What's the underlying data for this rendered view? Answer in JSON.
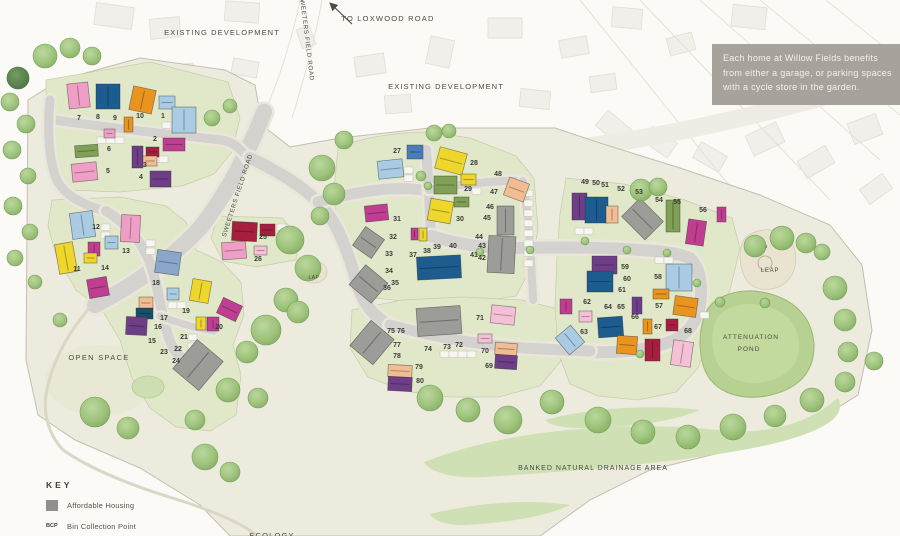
{
  "info_box": {
    "bg": "#a7a29b",
    "lines": [
      "Each home at Willow Fields benefits",
      "from either a garage, or parking spaces",
      "with a cycle store in the garden."
    ]
  },
  "key": {
    "title": "KEY",
    "items": [
      {
        "type": "swatch",
        "swatch_color": "#8f8f8b",
        "abbr": "",
        "label": "Affordable Housing"
      },
      {
        "type": "abbr",
        "abbr": "BCP",
        "label": "Bin Collection Point"
      },
      {
        "type": "abbr",
        "abbr": "LEAP",
        "label": "(Local Equipped Area of Play)"
      }
    ]
  },
  "labels": [
    {
      "id": "existing-development-1",
      "text": "EXISTING DEVELOPMENT",
      "x": 222,
      "y": 35,
      "size": 7.5,
      "ls": 1.1,
      "rot": 0
    },
    {
      "id": "existing-development-2",
      "text": "EXISTING DEVELOPMENT",
      "x": 446,
      "y": 89,
      "size": 7.5,
      "ls": 1.1,
      "rot": 0
    },
    {
      "id": "to-loxwood-road",
      "text": "TO LOXWOOD ROAD",
      "x": 388,
      "y": 21,
      "size": 7.5,
      "ls": 1.2,
      "rot": 0
    },
    {
      "id": "sweeters-field-road-top",
      "text": "SWEETERS FIELD ROAD",
      "x": 305,
      "y": 38,
      "size": 6.2,
      "ls": 0.7,
      "rot": 83
    },
    {
      "id": "sweeters-field-road-lower",
      "text": "SWEETERS FIELD ROAD",
      "x": 239,
      "y": 196,
      "size": 6.2,
      "ls": 0.7,
      "rot": -72
    },
    {
      "id": "open-space",
      "text": "OPEN SPACE",
      "x": 99,
      "y": 360,
      "size": 7.5,
      "ls": 1.3,
      "rot": 0
    },
    {
      "id": "lap",
      "text": "LAP",
      "x": 314,
      "y": 279,
      "size": 5,
      "ls": 0.5,
      "rot": 0
    },
    {
      "id": "leap",
      "text": "LEAP",
      "x": 770,
      "y": 272,
      "size": 6,
      "ls": 0.8,
      "rot": 0
    },
    {
      "id": "attenuation-pond-1",
      "text": "ATTENUATION",
      "x": 751,
      "y": 339,
      "size": 6.5,
      "ls": 1,
      "rot": 0
    },
    {
      "id": "attenuation-pond-2",
      "text": "POND",
      "x": 749,
      "y": 351,
      "size": 6.5,
      "ls": 1,
      "rot": 0
    },
    {
      "id": "banked-natural-drainage-area",
      "text": "BANKED NATURAL DRAINAGE AREA",
      "x": 593,
      "y": 470,
      "size": 7,
      "ls": 1,
      "rot": 0
    },
    {
      "id": "ecology",
      "text": "ECOLOGY",
      "x": 272,
      "y": 538,
      "size": 7.5,
      "ls": 1.2,
      "rot": 0
    }
  ],
  "palette": {
    "pink": "#ef9fc6",
    "pinkl": "#f4c0d6",
    "navy": "#1d5c8e",
    "orange": "#e8941f",
    "ltblue": "#a9cbe4",
    "green": "#7fa055",
    "yellow": "#eed62c",
    "magenta": "#bf3e92",
    "red": "#a61f3e",
    "purple": "#6f3e88",
    "peach": "#f2bd92",
    "bluegray": "#8aa6cb",
    "teal": "#174f6b",
    "gray": "#9c9c98",
    "gray2": "#8f8f8b",
    "blue": "#4a7cb8"
  },
  "plots": [
    [
      1,
      163,
      118
    ],
    [
      2,
      155,
      141
    ],
    [
      3,
      145,
      167
    ],
    [
      4,
      141,
      179
    ],
    [
      5,
      108,
      173
    ],
    [
      6,
      109,
      151
    ],
    [
      7,
      79,
      120
    ],
    [
      8,
      98,
      119
    ],
    [
      9,
      115,
      120
    ],
    [
      10,
      140,
      118
    ],
    [
      11,
      77,
      271
    ],
    [
      12,
      96,
      229
    ],
    [
      13,
      126,
      253
    ],
    [
      14,
      105,
      270
    ],
    [
      15,
      152,
      343
    ],
    [
      16,
      158,
      329
    ],
    [
      17,
      164,
      320
    ],
    [
      18,
      156,
      285
    ],
    [
      19,
      186,
      313
    ],
    [
      20,
      219,
      329
    ],
    [
      21,
      184,
      339
    ],
    [
      22,
      178,
      351
    ],
    [
      23,
      164,
      354
    ],
    [
      24,
      176,
      363
    ],
    [
      25,
      263,
      239
    ],
    [
      26,
      258,
      261
    ],
    [
      27,
      397,
      153
    ],
    [
      28,
      474,
      165
    ],
    [
      29,
      468,
      191
    ],
    [
      30,
      460,
      221
    ],
    [
      31,
      397,
      221
    ],
    [
      32,
      393,
      239
    ],
    [
      33,
      389,
      256
    ],
    [
      34,
      389,
      273
    ],
    [
      35,
      395,
      285
    ],
    [
      36,
      387,
      290
    ],
    [
      37,
      413,
      257
    ],
    [
      38,
      427,
      253
    ],
    [
      39,
      437,
      249
    ],
    [
      40,
      453,
      248
    ],
    [
      41,
      474,
      257
    ],
    [
      42,
      482,
      260
    ],
    [
      43,
      482,
      248
    ],
    [
      44,
      479,
      239
    ],
    [
      45,
      487,
      220
    ],
    [
      46,
      490,
      209
    ],
    [
      47,
      494,
      194
    ],
    [
      48,
      498,
      176
    ],
    [
      49,
      585,
      184
    ],
    [
      50,
      596,
      185
    ],
    [
      51,
      605,
      187
    ],
    [
      52,
      621,
      191
    ],
    [
      53,
      639,
      194
    ],
    [
      54,
      659,
      202
    ],
    [
      55,
      677,
      204
    ],
    [
      56,
      703,
      212
    ],
    [
      57,
      659,
      308
    ],
    [
      58,
      658,
      279
    ],
    [
      59,
      625,
      269
    ],
    [
      60,
      627,
      281
    ],
    [
      61,
      622,
      292
    ],
    [
      62,
      587,
      304
    ],
    [
      63,
      584,
      334
    ],
    [
      64,
      608,
      309
    ],
    [
      65,
      621,
      309
    ],
    [
      66,
      635,
      319
    ],
    [
      67,
      658,
      329
    ],
    [
      68,
      688,
      333
    ],
    [
      69,
      489,
      368
    ],
    [
      70,
      485,
      353
    ],
    [
      71,
      480,
      320
    ],
    [
      72,
      459,
      347
    ],
    [
      73,
      447,
      349
    ],
    [
      74,
      428,
      351
    ],
    [
      75,
      391,
      333
    ],
    [
      76,
      401,
      333
    ],
    [
      77,
      397,
      347
    ],
    [
      78,
      397,
      358
    ],
    [
      79,
      419,
      369
    ],
    [
      80,
      420,
      383
    ]
  ],
  "houses": [
    [
      68,
      83,
      21,
      25,
      -6,
      "pink"
    ],
    [
      96,
      84,
      24,
      25,
      0,
      "navy"
    ],
    [
      131,
      88,
      23,
      24,
      12,
      "orange"
    ],
    [
      159,
      96,
      16,
      13,
      0,
      "ltblue"
    ],
    [
      172,
      107,
      24,
      26,
      0,
      "ltblue"
    ],
    [
      124,
      117,
      9,
      15,
      0,
      "orange"
    ],
    [
      104,
      129,
      11,
      9,
      0,
      "pink"
    ],
    [
      163,
      138,
      22,
      13,
      0,
      "magenta"
    ],
    [
      146,
      147,
      13,
      10,
      0,
      "red"
    ],
    [
      132,
      146,
      11,
      22,
      0,
      "purple"
    ],
    [
      75,
      145,
      23,
      12,
      -4,
      "green"
    ],
    [
      143,
      156,
      14,
      10,
      0,
      "peach"
    ],
    [
      72,
      163,
      25,
      18,
      -6,
      "pink"
    ],
    [
      150,
      171,
      21,
      16,
      0,
      "purple"
    ],
    [
      71,
      212,
      23,
      26,
      -8,
      "ltblue"
    ],
    [
      121,
      215,
      19,
      27,
      3,
      "pink"
    ],
    [
      105,
      236,
      13,
      13,
      0,
      "ltblue"
    ],
    [
      57,
      243,
      18,
      30,
      -10,
      "yellow"
    ],
    [
      88,
      242,
      12,
      14,
      0,
      "magenta"
    ],
    [
      84,
      253,
      13,
      10,
      0,
      "yellow"
    ],
    [
      88,
      278,
      20,
      19,
      -10,
      "magenta"
    ],
    [
      156,
      251,
      24,
      23,
      8,
      "bluegray"
    ],
    [
      167,
      288,
      12,
      12,
      0,
      "ltblue"
    ],
    [
      191,
      280,
      19,
      22,
      10,
      "yellow"
    ],
    [
      139,
      297,
      14,
      12,
      0,
      "peach"
    ],
    [
      136,
      308,
      17,
      11,
      0,
      "teal"
    ],
    [
      126,
      317,
      21,
      18,
      3,
      "purple"
    ],
    [
      196,
      317,
      10,
      13,
      0,
      "yellow"
    ],
    [
      207,
      317,
      12,
      14,
      0,
      "magenta"
    ],
    [
      219,
      301,
      21,
      17,
      25,
      "magenta"
    ],
    [
      181,
      346,
      34,
      38,
      40,
      "gray"
    ],
    [
      232,
      222,
      25,
      19,
      3,
      "red"
    ],
    [
      260,
      224,
      15,
      12,
      0,
      "red"
    ],
    [
      222,
      242,
      24,
      17,
      -4,
      "pink"
    ],
    [
      254,
      246,
      13,
      9,
      0,
      "pinkl"
    ],
    [
      407,
      145,
      16,
      14,
      0,
      "blue"
    ],
    [
      378,
      160,
      25,
      18,
      -6,
      "ltblue"
    ],
    [
      437,
      150,
      28,
      22,
      15,
      "yellow"
    ],
    [
      461,
      174,
      15,
      11,
      0,
      "yellow"
    ],
    [
      434,
      176,
      23,
      18,
      0,
      "green"
    ],
    [
      454,
      197,
      15,
      10,
      0,
      "green"
    ],
    [
      429,
      200,
      23,
      22,
      10,
      "yellow"
    ],
    [
      365,
      205,
      23,
      16,
      -6,
      "magenta"
    ],
    [
      357,
      231,
      23,
      23,
      35,
      "gray"
    ],
    [
      411,
      228,
      7,
      12,
      0,
      "magenta"
    ],
    [
      419,
      228,
      8,
      13,
      0,
      "yellow"
    ],
    [
      506,
      180,
      21,
      19,
      20,
      "peach"
    ],
    [
      497,
      206,
      17,
      29,
      0,
      "gray"
    ],
    [
      488,
      236,
      27,
      37,
      3,
      "gray"
    ],
    [
      354,
      271,
      29,
      26,
      40,
      "gray"
    ],
    [
      417,
      256,
      44,
      23,
      -3,
      "navy"
    ],
    [
      357,
      326,
      30,
      33,
      40,
      "gray"
    ],
    [
      417,
      307,
      44,
      28,
      -4,
      "gray"
    ],
    [
      388,
      365,
      24,
      12,
      3,
      "peach"
    ],
    [
      388,
      377,
      24,
      14,
      3,
      "purple"
    ],
    [
      491,
      306,
      24,
      18,
      6,
      "pinkl"
    ],
    [
      478,
      334,
      14,
      9,
      0,
      "pinkl"
    ],
    [
      495,
      343,
      22,
      12,
      4,
      "peach"
    ],
    [
      495,
      355,
      22,
      14,
      4,
      "purple"
    ],
    [
      572,
      193,
      15,
      27,
      0,
      "purple"
    ],
    [
      585,
      197,
      23,
      26,
      0,
      "navy"
    ],
    [
      606,
      206,
      12,
      17,
      0,
      "peach"
    ],
    [
      626,
      206,
      33,
      26,
      45,
      "gray"
    ],
    [
      666,
      200,
      14,
      32,
      0,
      "green"
    ],
    [
      687,
      220,
      18,
      25,
      8,
      "magenta"
    ],
    [
      717,
      207,
      9,
      15,
      0,
      "magenta"
    ],
    [
      592,
      256,
      25,
      18,
      0,
      "purple"
    ],
    [
      587,
      271,
      26,
      21,
      0,
      "navy"
    ],
    [
      666,
      264,
      26,
      27,
      0,
      "ltblue"
    ],
    [
      653,
      289,
      16,
      10,
      0,
      "orange"
    ],
    [
      632,
      297,
      10,
      17,
      0,
      "purple"
    ],
    [
      674,
      297,
      23,
      19,
      8,
      "orange"
    ],
    [
      560,
      299,
      12,
      15,
      0,
      "magenta"
    ],
    [
      579,
      311,
      13,
      11,
      0,
      "pinkl"
    ],
    [
      598,
      317,
      25,
      20,
      -4,
      "navy"
    ],
    [
      560,
      329,
      20,
      22,
      -40,
      "ltblue"
    ],
    [
      617,
      336,
      20,
      18,
      4,
      "orange"
    ],
    [
      643,
      319,
      9,
      15,
      0,
      "orange"
    ],
    [
      645,
      339,
      15,
      22,
      0,
      "red"
    ],
    [
      666,
      319,
      12,
      12,
      0,
      "red"
    ],
    [
      672,
      341,
      20,
      25,
      8,
      "pinkl"
    ]
  ],
  "trees": [
    [
      45,
      56,
      12,
      0
    ],
    [
      70,
      48,
      10,
      0
    ],
    [
      92,
      56,
      9,
      0
    ],
    [
      18,
      78,
      11,
      1
    ],
    [
      10,
      102,
      9,
      0
    ],
    [
      26,
      124,
      9,
      0
    ],
    [
      12,
      150,
      9,
      0
    ],
    [
      28,
      176,
      8,
      0
    ],
    [
      13,
      206,
      9,
      0
    ],
    [
      30,
      232,
      8,
      0
    ],
    [
      15,
      258,
      8,
      0
    ],
    [
      35,
      282,
      7,
      0
    ],
    [
      60,
      320,
      7,
      0
    ],
    [
      95,
      412,
      15,
      0
    ],
    [
      128,
      428,
      11,
      0
    ],
    [
      205,
      457,
      13,
      0
    ],
    [
      230,
      472,
      10,
      0
    ],
    [
      212,
      118,
      8,
      0
    ],
    [
      230,
      106,
      7,
      0
    ],
    [
      322,
      168,
      13,
      0
    ],
    [
      334,
      194,
      11,
      0
    ],
    [
      320,
      216,
      9,
      0
    ],
    [
      290,
      240,
      14,
      0
    ],
    [
      308,
      268,
      13,
      0
    ],
    [
      286,
      300,
      12,
      0
    ],
    [
      266,
      330,
      15,
      0
    ],
    [
      298,
      312,
      11,
      0
    ],
    [
      247,
      352,
      11,
      0
    ],
    [
      228,
      390,
      12,
      0
    ],
    [
      258,
      398,
      10,
      0
    ],
    [
      195,
      420,
      10,
      0
    ],
    [
      344,
      140,
      9,
      0
    ],
    [
      434,
      133,
      8,
      0
    ],
    [
      449,
      131,
      7,
      0
    ],
    [
      421,
      176,
      5,
      0
    ],
    [
      428,
      186,
      4,
      0
    ],
    [
      641,
      190,
      11,
      0
    ],
    [
      658,
      187,
      9,
      0
    ],
    [
      585,
      241,
      4,
      0
    ],
    [
      627,
      250,
      4,
      0
    ],
    [
      667,
      253,
      4,
      0
    ],
    [
      697,
      283,
      4,
      0
    ],
    [
      640,
      354,
      4,
      0
    ],
    [
      530,
      250,
      4,
      0
    ],
    [
      480,
      252,
      4,
      0
    ],
    [
      755,
      246,
      11,
      0
    ],
    [
      782,
      238,
      12,
      0
    ],
    [
      806,
      243,
      10,
      0
    ],
    [
      822,
      252,
      8,
      0
    ],
    [
      835,
      288,
      12,
      0
    ],
    [
      845,
      320,
      11,
      0
    ],
    [
      848,
      352,
      10,
      0
    ],
    [
      720,
      302,
      5,
      0
    ],
    [
      765,
      303,
      5,
      0
    ],
    [
      430,
      398,
      13,
      0
    ],
    [
      468,
      410,
      12,
      0
    ],
    [
      508,
      420,
      14,
      0
    ],
    [
      552,
      402,
      12,
      0
    ],
    [
      598,
      420,
      13,
      0
    ],
    [
      643,
      432,
      12,
      0
    ],
    [
      688,
      437,
      12,
      0
    ],
    [
      733,
      427,
      13,
      0
    ],
    [
      775,
      416,
      11,
      0
    ],
    [
      812,
      400,
      12,
      0
    ],
    [
      845,
      382,
      10,
      0
    ],
    [
      874,
      361,
      9,
      0
    ]
  ],
  "parking": [
    [
      162,
      122
    ],
    [
      171,
      122
    ],
    [
      150,
      156
    ],
    [
      159,
      156
    ],
    [
      97,
      137
    ],
    [
      106,
      137
    ],
    [
      115,
      137
    ],
    [
      101,
      224
    ],
    [
      101,
      232
    ],
    [
      146,
      240
    ],
    [
      146,
      248
    ],
    [
      168,
      302
    ],
    [
      177,
      302
    ],
    [
      188,
      334
    ],
    [
      188,
      343
    ],
    [
      277,
      224
    ],
    [
      277,
      233
    ],
    [
      404,
      167
    ],
    [
      404,
      175
    ],
    [
      472,
      188
    ],
    [
      524,
      190
    ],
    [
      524,
      200
    ],
    [
      524,
      210
    ],
    [
      524,
      220
    ],
    [
      524,
      230
    ],
    [
      524,
      240
    ],
    [
      524,
      250
    ],
    [
      524,
      260
    ],
    [
      440,
      351
    ],
    [
      449,
      351
    ],
    [
      458,
      351
    ],
    [
      467,
      351
    ],
    [
      575,
      228
    ],
    [
      584,
      228
    ],
    [
      655,
      257
    ],
    [
      664,
      257
    ],
    [
      700,
      312
    ]
  ],
  "existing_buildings": [
    [
      95,
      5,
      38,
      22,
      8
    ],
    [
      150,
      18,
      30,
      20,
      -5
    ],
    [
      225,
      2,
      34,
      20,
      4
    ],
    [
      296,
      30,
      20,
      14,
      70
    ],
    [
      355,
      55,
      30,
      20,
      -8
    ],
    [
      428,
      38,
      24,
      28,
      12
    ],
    [
      488,
      18,
      34,
      20,
      0
    ],
    [
      560,
      38,
      28,
      18,
      -10
    ],
    [
      612,
      8,
      30,
      20,
      5
    ],
    [
      668,
      35,
      26,
      18,
      -15
    ],
    [
      732,
      6,
      34,
      22,
      6
    ],
    [
      598,
      118,
      32,
      20,
      40
    ],
    [
      645,
      133,
      30,
      18,
      35
    ],
    [
      695,
      148,
      30,
      18,
      30
    ],
    [
      748,
      128,
      34,
      22,
      -25
    ],
    [
      800,
      152,
      32,
      20,
      -30
    ],
    [
      850,
      118,
      30,
      22,
      -20
    ],
    [
      862,
      180,
      28,
      18,
      -35
    ],
    [
      232,
      60,
      26,
      16,
      10
    ],
    [
      172,
      64,
      22,
      14,
      -6
    ],
    [
      385,
      95,
      26,
      18,
      -4
    ],
    [
      520,
      90,
      30,
      18,
      6
    ],
    [
      590,
      75,
      26,
      16,
      -8
    ]
  ]
}
